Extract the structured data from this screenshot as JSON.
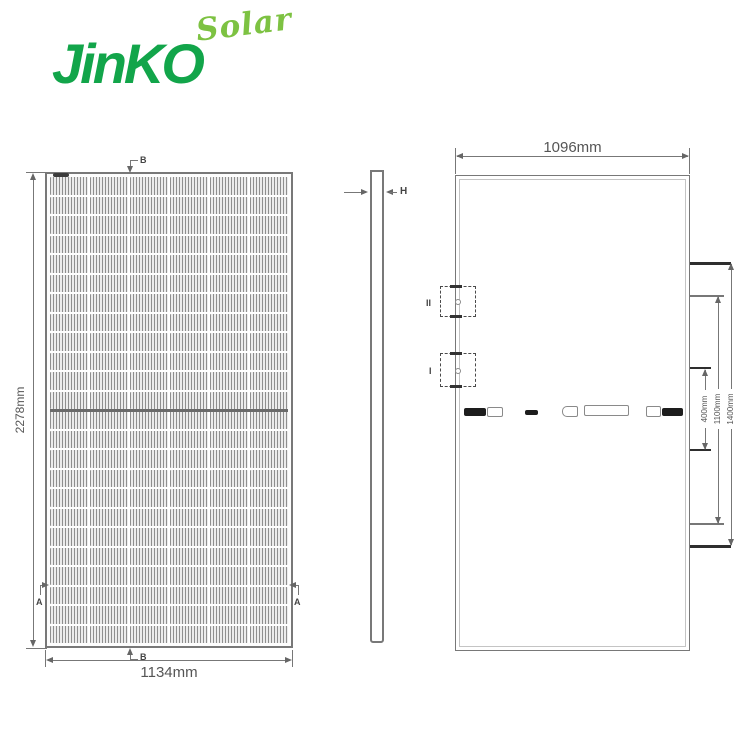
{
  "logo": {
    "brand": "JinKO",
    "sub": "Solar",
    "brand_color": "#12A54A",
    "sub_color": "#7DC242"
  },
  "front_view": {
    "height_dim": "2278mm",
    "width_dim": "1134mm",
    "section_a": "A",
    "section_b": "B",
    "grid": {
      "cols": 6,
      "rows": 24
    }
  },
  "side_view": {
    "thickness_label": "H"
  },
  "back_view": {
    "width_dim": "1096mm",
    "detail_i": "I",
    "detail_ii": "II",
    "hole_dims": {
      "inner": "400mm",
      "middle": "1100mm",
      "outer": "1400mm"
    }
  },
  "colors": {
    "line_gray": "#777777",
    "dark_line": "#2e2e2e"
  }
}
